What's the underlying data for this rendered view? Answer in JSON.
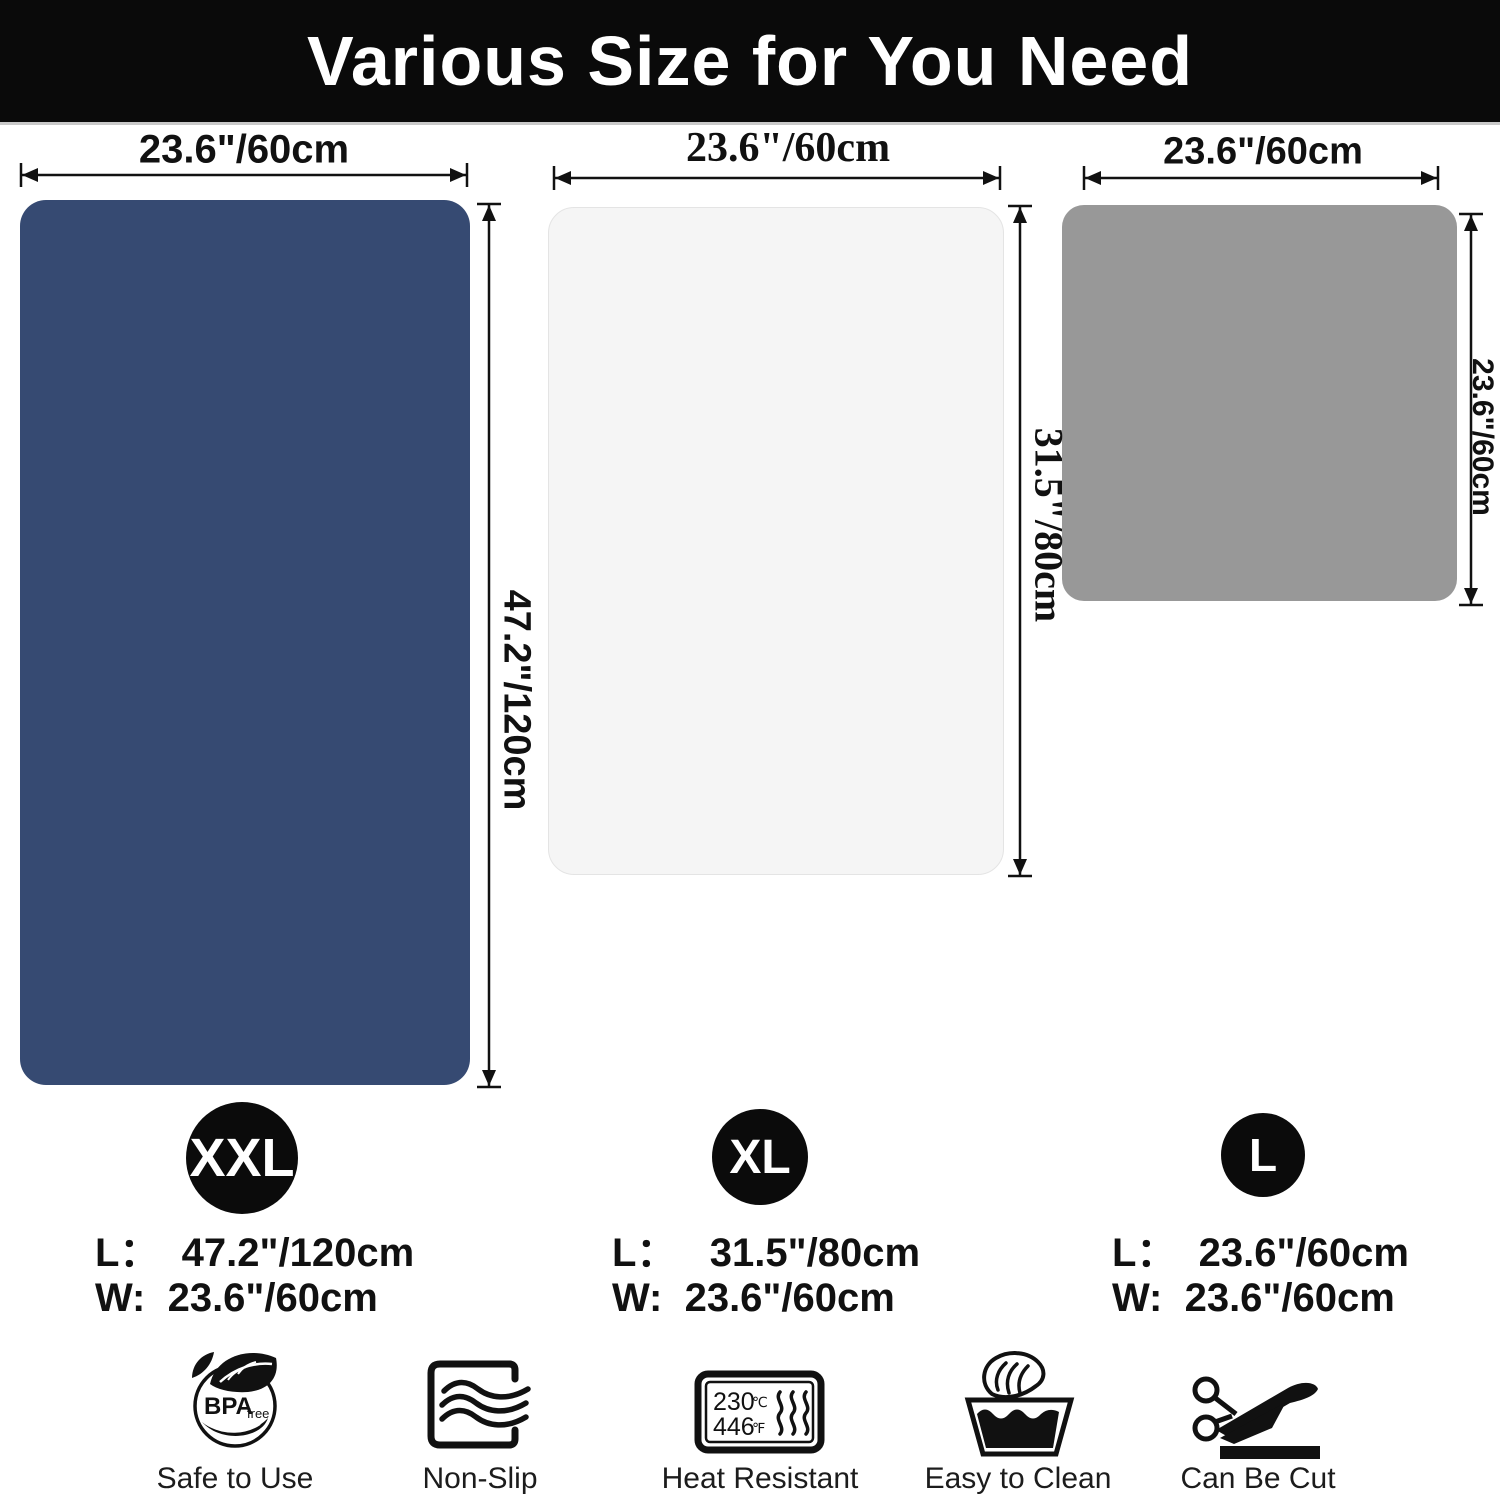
{
  "header": {
    "title": "Various Size for You Need"
  },
  "colors": {
    "header_bg": "#0a0a0a",
    "header_text": "#ffffff",
    "arrow": "#111111",
    "mat_xxl": "#364a72",
    "mat_xl": "#f5f5f5",
    "mat_l": "#989898",
    "badge_bg": "#0b0b0b",
    "badge_text": "#ffffff"
  },
  "mats": {
    "xxl": {
      "width_label": "23.6\"/60cm",
      "height_label": "47.2\"/120cm"
    },
    "xl": {
      "width_label": "23.6\"/60cm",
      "height_label": "31.5\"/80cm"
    },
    "l": {
      "width_label": "23.6\"/60cm",
      "height_label": "23.6\"/60cm"
    }
  },
  "sizes": {
    "xxl": {
      "badge": "XXL",
      "length": "L：  47.2\"/120cm",
      "width": "W:  23.6\"/60cm"
    },
    "xl": {
      "badge": "XL",
      "length": "L：   31.5\"/80cm",
      "width": "W:  23.6\"/60cm"
    },
    "l": {
      "badge": "L",
      "length": "L：  23.6\"/60cm",
      "width": "W:  23.6\"/60cm"
    }
  },
  "features": [
    {
      "label": "Safe to Use",
      "icon": "bpa-free-icon",
      "icon_text_main": "BPA",
      "icon_text_sub": "free"
    },
    {
      "label": "Non-Slip",
      "icon": "non-slip-icon"
    },
    {
      "label": "Heat Resistant",
      "icon": "heat-resistant-icon",
      "temp_c": "230",
      "temp_c_unit": "℃",
      "temp_f": "446",
      "temp_f_unit": "℉"
    },
    {
      "label": "Easy to Clean",
      "icon": "wash-hand-icon"
    },
    {
      "label": "Can Be Cut",
      "icon": "scissors-icon"
    }
  ]
}
